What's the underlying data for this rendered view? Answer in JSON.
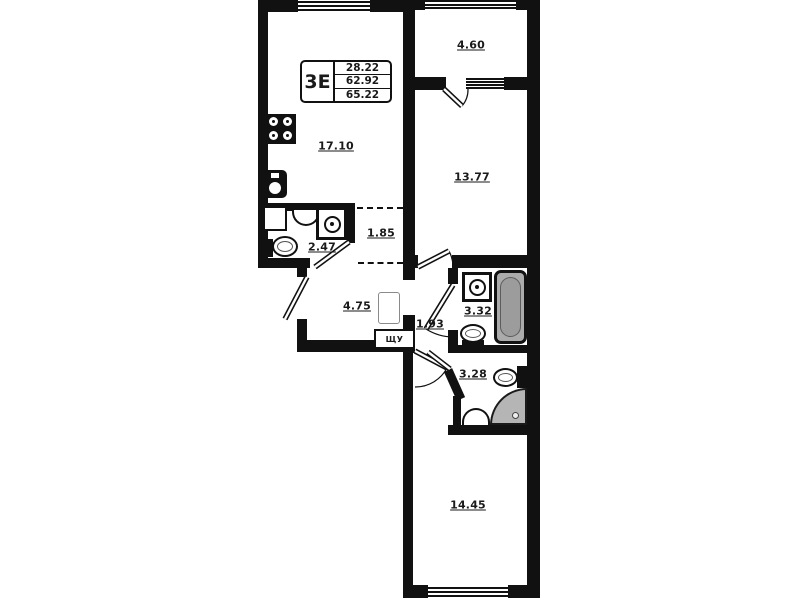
{
  "title_block": {
    "type_label": "3Е",
    "living_area": "28.22",
    "second_area": "62.92",
    "total_area": "65.22"
  },
  "rooms": [
    {
      "name": "kitchen-living",
      "area": "17.10"
    },
    {
      "name": "balcony",
      "area": "4.60"
    },
    {
      "name": "bedroom-top",
      "area": "13.77"
    },
    {
      "name": "wc-small",
      "area": "2.47"
    },
    {
      "name": "wardrobe-niche",
      "area": "1.85"
    },
    {
      "name": "hallway",
      "area": "4.75"
    },
    {
      "name": "corridor",
      "area": "1.93"
    },
    {
      "name": "bathroom",
      "area": "3.32"
    },
    {
      "name": "shower-wc",
      "area": "3.28"
    },
    {
      "name": "bedroom-bottom",
      "area": "14.45"
    }
  ],
  "labels": {
    "electrical_panel": "ЩУ"
  },
  "fixtures": [
    "stove-icon",
    "kitchen-sink-icon",
    "wash-basin-icon",
    "washing-machine-icon",
    "toilet-icon",
    "bathtub-icon",
    "corner-shower-icon"
  ],
  "colors": {
    "wall": "#111111",
    "background": "#ffffff",
    "bathtub_fill": "#ababab",
    "shower_fill": "#b5b5b5",
    "text": "#1a1a1a"
  }
}
